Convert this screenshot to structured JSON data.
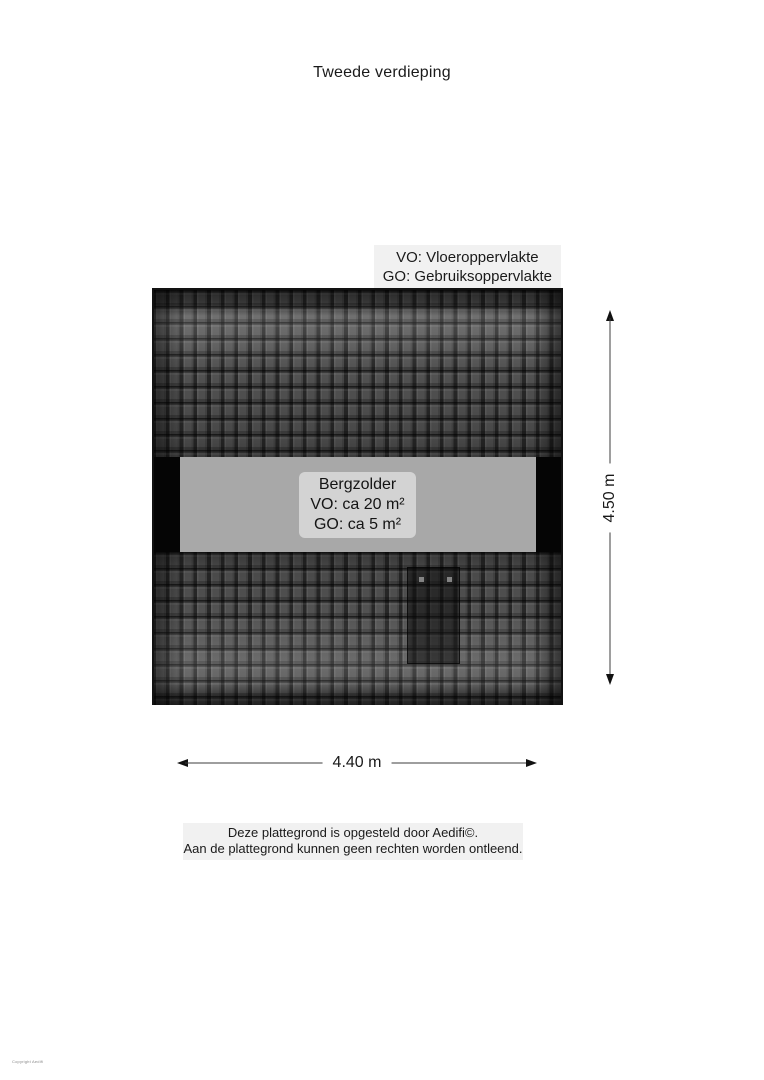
{
  "page": {
    "title": "Tweede verdieping"
  },
  "legend": {
    "line1": "VO: Vloeroppervlakte",
    "line2": "GO: Gebruiksoppervlakte"
  },
  "floorplan": {
    "room": {
      "name": "Bergzolder",
      "vo": "VO: ca 20 m²",
      "go": "GO: ca 5 m²"
    }
  },
  "dimensions": {
    "height": "4.50 m",
    "width": "4.40 m"
  },
  "footer": {
    "line1": "Deze plattegrond is opgesteld door Aedifi©.",
    "line2": "Aan de plattegrond kunnen geen rechten worden ontleend."
  },
  "copyright": "Copyright Aedifi",
  "colors": {
    "roof_tile": "#575757",
    "roof_edge": "#121212",
    "attic_band": "#a8a8a8",
    "wall_black": "#050505",
    "room_label_bg": "#d3d3d3",
    "legend_bg": "#f1f1f1",
    "footer_bg": "#f1f1f1",
    "text": "#1a1a1a"
  }
}
